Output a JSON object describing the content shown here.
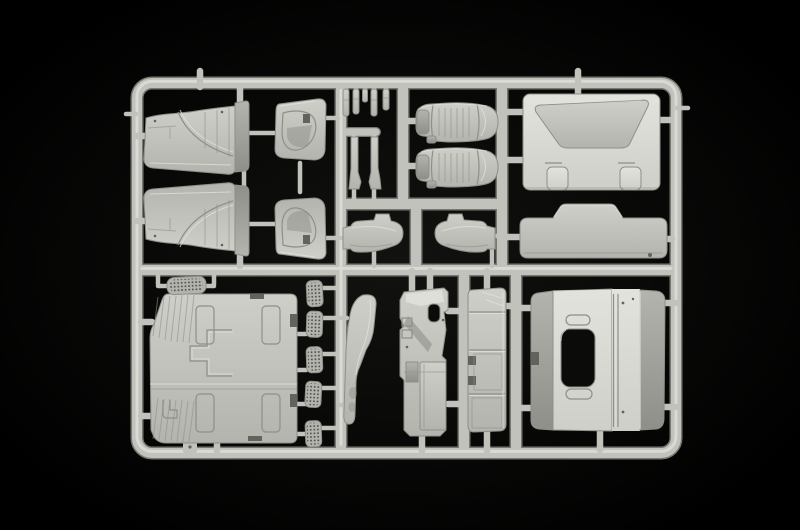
{
  "scene": {
    "alt": "Photograph of a light grey injection-moulded plastic model kit sprue (parts tree) with truck cab components, on a black background",
    "media_type": "photograph",
    "subject": "plastic model kit sprue with truck cab parts",
    "background_color_name": "black",
    "plastic_color_name": "light grey"
  },
  "palette": {
    "bg": "#000000",
    "bgglow": "#121210",
    "p1": "#e3e3dd",
    "p2": "#cfcfc9",
    "p3": "#b4b4ae",
    "p4": "#8f8f89",
    "p5": "#63635d",
    "runner": "#c2c2bc",
    "runnersh": "#787872",
    "runnerhi": "#e4e4de",
    "hole": "#0b0b0a",
    "meshdot": "#4e4e48"
  },
  "parts_inventory": [
    {
      "id": "door-outer-panel",
      "label": "Cab door outer panel",
      "count": 2
    },
    {
      "id": "door-trim-panel",
      "label": "Door interior trim panel",
      "count": 2
    },
    {
      "id": "small-lever",
      "label": "Small lever / handle",
      "count": 5
    },
    {
      "id": "pillar-strip",
      "label": "Pillar trim strip",
      "count": 2
    },
    {
      "id": "seat",
      "label": "Cab seat",
      "count": 2
    },
    {
      "id": "rear-wall-panel",
      "label": "Cab rear wall panel",
      "count": 1
    },
    {
      "id": "roof-insert-panel",
      "label": "Roof insert panel with raised hump",
      "count": 1
    },
    {
      "id": "console-shell",
      "label": "Console housing shell",
      "count": 2
    },
    {
      "id": "floor-panel",
      "label": "Cab floor panel",
      "count": 1
    },
    {
      "id": "step-grille",
      "label": "Perforated step grille",
      "count": 6
    },
    {
      "id": "corner-deflector",
      "label": "Corner wind deflector panel",
      "count": 1
    },
    {
      "id": "dashboard-module",
      "label": "Dashboard / engine tunnel module",
      "count": 1
    },
    {
      "id": "side-fairing",
      "label": "Side fairing with storage boxes",
      "count": 1
    },
    {
      "id": "back-panel-window",
      "label": "Cab back panel with window opening",
      "count": 1
    }
  ]
}
